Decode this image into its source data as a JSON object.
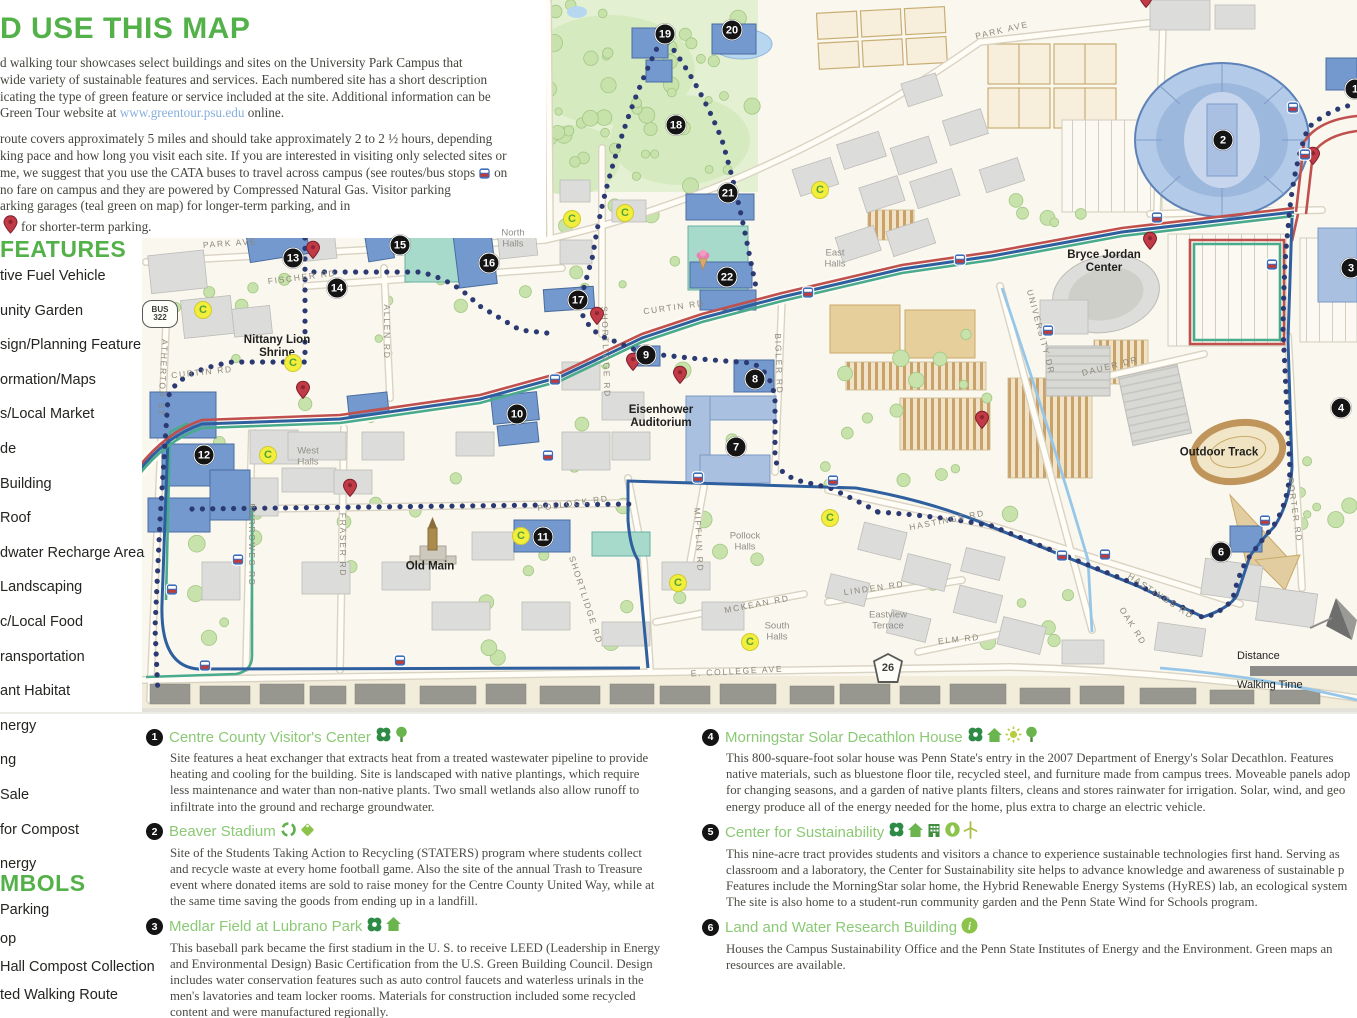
{
  "colors": {
    "heading_green": "#54b14a",
    "site_title_green": "#8bc975",
    "link_blue": "#86aede",
    "route_red": "#c0504d",
    "route_blue": "#2e5f9e",
    "route_teal": "#49ab8c",
    "walk_dot_navy": "#2b3a72"
  },
  "intro": {
    "heading": "D USE THIS MAP",
    "p1": [
      "d walking tour showcases select buildings and sites on the University Park Campus that",
      "wide variety of sustainable features and services. Each numbered site has a short description",
      "icating the type of green feature or service included at the site. Additional information can be"
    ],
    "p1_link_pre": "Green Tour website at ",
    "p1_link": "www.greentour.psu.edu",
    "p1_link_post": " online.",
    "p2": [
      "route covers approximately 5 miles and should take approximately 2 to 2 ½ hours, depending",
      "king pace and how long you visit each site. If you are interested in visiting only selected sites or"
    ],
    "p2_bus_pre": "me, we suggest that you use the CATA buses to travel across campus (see routes/bus stops",
    "p2_bus_post": "on",
    "p2b": [
      "no fare on campus and they are powered by Compressed Natural Gas. Visitor parking",
      "arking garages (teal green on map) for longer-term parking, and in"
    ],
    "p2_pin_post": "for shorter-term parking."
  },
  "sidebar": {
    "features_title": "FEATURES",
    "features": [
      "tive Fuel Vehicle",
      "unity Garden",
      "sign/Planning Feature",
      "ormation/Maps",
      "s/Local Market",
      "de",
      "Building",
      "Roof",
      "dwater Recharge Area",
      "Landscaping",
      "c/Local Food",
      "ransportation",
      "ant Habitat",
      "nergy",
      "ng",
      "Sale",
      "for Compost",
      "nergy"
    ],
    "symbols_title": "MBOLS",
    "symbols": [
      "Parking",
      "op",
      "Hall Compost Collection",
      "ted Walking Route"
    ]
  },
  "map": {
    "markers": [
      {
        "n": "1",
        "x": 1355,
        "y": 89
      },
      {
        "n": "2",
        "x": 1223,
        "y": 140
      },
      {
        "n": "3",
        "x": 1351,
        "y": 268
      },
      {
        "n": "4",
        "x": 1341,
        "y": 408
      },
      {
        "n": "6",
        "x": 1221,
        "y": 552
      },
      {
        "n": "7",
        "x": 736,
        "y": 447
      },
      {
        "n": "8",
        "x": 755,
        "y": 379
      },
      {
        "n": "9",
        "x": 646,
        "y": 355
      },
      {
        "n": "10",
        "x": 517,
        "y": 414
      },
      {
        "n": "11",
        "x": 543,
        "y": 537
      },
      {
        "n": "12",
        "x": 204,
        "y": 455
      },
      {
        "n": "13",
        "x": 293,
        "y": 258
      },
      {
        "n": "14",
        "x": 337,
        "y": 288
      },
      {
        "n": "15",
        "x": 400,
        "y": 245
      },
      {
        "n": "16",
        "x": 489,
        "y": 263
      },
      {
        "n": "17",
        "x": 578,
        "y": 300
      },
      {
        "n": "18",
        "x": 676,
        "y": 125
      },
      {
        "n": "19",
        "x": 665,
        "y": 34
      },
      {
        "n": "20",
        "x": 732,
        "y": 30
      },
      {
        "n": "21",
        "x": 728,
        "y": 193
      },
      {
        "n": "22",
        "x": 727,
        "y": 277
      }
    ],
    "road_labels": [
      {
        "t": "PARK  AVE",
        "x": 230,
        "y": 243,
        "r": -4
      },
      {
        "t": "PARK  AVE",
        "x": 1002,
        "y": 30,
        "r": -13
      },
      {
        "t": "FISCHER  RD",
        "x": 302,
        "y": 277,
        "r": -7
      },
      {
        "t": "ALLEN  RD",
        "x": 387,
        "y": 332,
        "r": 90
      },
      {
        "t": "ATHERTON  ST",
        "x": 163,
        "y": 378,
        "r": 93
      },
      {
        "t": "CURTIN  RD",
        "x": 202,
        "y": 372,
        "r": -6
      },
      {
        "t": "CURTIN  RD",
        "x": 674,
        "y": 307,
        "r": -8
      },
      {
        "t": "BURROWES  RD",
        "x": 252,
        "y": 545,
        "r": 90
      },
      {
        "t": "FRASER  RD",
        "x": 343,
        "y": 545,
        "r": 90
      },
      {
        "t": "SHORTLIDGE  RD",
        "x": 606,
        "y": 352,
        "r": 88
      },
      {
        "t": "SHORTLIDGE  RD",
        "x": 586,
        "y": 600,
        "r": 72
      },
      {
        "t": "MIFFLIN  RD",
        "x": 699,
        "y": 540,
        "r": 87
      },
      {
        "t": "BIGLER  RD",
        "x": 779,
        "y": 364,
        "r": 88
      },
      {
        "t": "POLLOCK  RD",
        "x": 573,
        "y": 503,
        "r": -8
      },
      {
        "t": "MCKEAN  RD",
        "x": 757,
        "y": 604,
        "r": -11
      },
      {
        "t": "LINDEN  RD",
        "x": 874,
        "y": 588,
        "r": -8
      },
      {
        "t": "ELM  RD",
        "x": 959,
        "y": 639,
        "r": -6
      },
      {
        "t": "E. COLLEGE  AVE",
        "x": 737,
        "y": 671,
        "r": -3
      },
      {
        "t": "HASTINGS  RD",
        "x": 947,
        "y": 520,
        "r": -11
      },
      {
        "t": "HASTINGS  RD",
        "x": 1161,
        "y": 596,
        "r": 33
      },
      {
        "t": "OAK  RD",
        "x": 1133,
        "y": 626,
        "r": 58
      },
      {
        "t": "DAUER  DR",
        "x": 1110,
        "y": 366,
        "r": -14
      },
      {
        "t": "UNIVERSITY  DR",
        "x": 1041,
        "y": 332,
        "r": 75
      },
      {
        "t": "PORTER  RD",
        "x": 1295,
        "y": 510,
        "r": 82
      }
    ],
    "place_labels": [
      {
        "t": "North\nHalls",
        "x": 513,
        "y": 239
      },
      {
        "t": "West\nHalls",
        "x": 308,
        "y": 457
      },
      {
        "t": "East\nHalls",
        "x": 835,
        "y": 259
      },
      {
        "t": "Pollock\nHalls",
        "x": 745,
        "y": 542
      },
      {
        "t": "South\nHalls",
        "x": 777,
        "y": 632
      },
      {
        "t": "Eastview\nTerrace",
        "x": 888,
        "y": 621
      }
    ],
    "poi_labels": [
      {
        "t": "Nittany Lion\nShrine",
        "x": 277,
        "y": 347
      },
      {
        "t": "Old Main",
        "x": 430,
        "y": 567
      },
      {
        "t": "Eisenhower\nAuditorium",
        "x": 661,
        "y": 417
      },
      {
        "t": "Bryce Jordan\nCenter",
        "x": 1104,
        "y": 262
      },
      {
        "t": "Outdoor Track",
        "x": 1219,
        "y": 453
      }
    ],
    "pins": [
      {
        "x": 313,
        "y": 262
      },
      {
        "x": 303,
        "y": 402
      },
      {
        "x": 350,
        "y": 500
      },
      {
        "x": 597,
        "y": 328
      },
      {
        "x": 633,
        "y": 374
      },
      {
        "x": 680,
        "y": 387
      },
      {
        "x": 982,
        "y": 432
      },
      {
        "x": 1150,
        "y": 253
      },
      {
        "x": 1313,
        "y": 168
      },
      {
        "x": 1146,
        "y": 11
      }
    ],
    "buses": [
      {
        "x": 205,
        "y": 668
      },
      {
        "x": 400,
        "y": 663
      },
      {
        "x": 172,
        "y": 592
      },
      {
        "x": 238,
        "y": 562
      },
      {
        "x": 555,
        "y": 382
      },
      {
        "x": 548,
        "y": 458
      },
      {
        "x": 698,
        "y": 480
      },
      {
        "x": 833,
        "y": 483
      },
      {
        "x": 808,
        "y": 295
      },
      {
        "x": 960,
        "y": 262
      },
      {
        "x": 1048,
        "y": 333
      },
      {
        "x": 1062,
        "y": 558
      },
      {
        "x": 1105,
        "y": 557
      },
      {
        "x": 1157,
        "y": 220
      },
      {
        "x": 1272,
        "y": 267
      },
      {
        "x": 1293,
        "y": 110
      },
      {
        "x": 1305,
        "y": 157
      },
      {
        "x": 1265,
        "y": 523
      }
    ],
    "c_stops": [
      {
        "x": 203,
        "y": 310
      },
      {
        "x": 293,
        "y": 363
      },
      {
        "x": 268,
        "y": 455
      },
      {
        "x": 572,
        "y": 219
      },
      {
        "x": 625,
        "y": 213
      },
      {
        "x": 820,
        "y": 190
      },
      {
        "x": 830,
        "y": 518
      },
      {
        "x": 678,
        "y": 583
      },
      {
        "x": 750,
        "y": 642
      },
      {
        "x": 521,
        "y": 536
      }
    ],
    "icons": [
      {
        "name": "creamery-icon",
        "kind": "icecream",
        "x": 703,
        "y": 262
      }
    ],
    "shields": {
      "bus_label": "BUS",
      "bus_num": "322",
      "route_num": "26"
    },
    "scale": {
      "distance": "Distance",
      "walking": "Walking Time"
    }
  },
  "sites": {
    "left": [
      {
        "num": "1",
        "title": "Centre County Visitor's Center",
        "icons": [
          "pinwheel",
          "tree"
        ],
        "lines": [
          "Site features a heat exchanger that extracts heat from a treated wastewater pipeline to provide",
          "heating and cooling for the building. Site is landscaped with native plantings, which require",
          "less maintenance and water than non-native plants. Two small wetlands also allow runoff  to",
          "infiltrate into the ground and recharge groundwater."
        ]
      },
      {
        "num": "2",
        "title": "Beaver Stadium",
        "icons": [
          "recycle",
          "tag"
        ],
        "lines": [
          "Site of  the Students Taking Action to Recycling (STATERS) program where students collect",
          "and recycle waste at every home football game. Also the site of  the annual Trash to Treasure",
          "event where donated items are sold to raise money for the Centre County United Way, while at",
          "the same time saving the goods from ending up in a landfill."
        ]
      },
      {
        "num": "3",
        "title": "Medlar Field at Lubrano Park",
        "icons": [
          "pinwheel",
          "house"
        ],
        "lines": [
          "This baseball park became the first stadium in the U. S. to receive LEED (Leadership in Energy",
          "and Environmental Design) Basic Certification from the U.S. Green Building Council. Design",
          "includes water conservation features such as auto control faucets and waterless urinals in the",
          "men's lavatories and team locker rooms. Materials for construction included some recycled",
          "content and were manufactured regionally."
        ]
      }
    ],
    "right": [
      {
        "num": "4",
        "title": "Morningstar Solar Decathlon House",
        "icons": [
          "pinwheel",
          "house",
          "sun",
          "tree"
        ],
        "lines": [
          "This 800-square-foot solar house was Penn State's entry in the 2007 Department of  Energy's Solar Decathlon. Features",
          "native materials, such as bluestone floor tile, recycled steel, and furniture made from campus trees. Moveable panels adop",
          "for changing seasons, and a garden of  native plants filters, cleans and stores rainwater for irrigation. Solar, wind, and geo",
          "energy produce all of  the energy needed for the home, plus extra to charge an electric vehicle."
        ]
      },
      {
        "num": "5",
        "title": "Center for Sustainability",
        "icons": [
          "pinwheel",
          "house",
          "building",
          "leaf",
          "turbine"
        ],
        "lines": [
          "This nine-acre tract provides students and visitors a chance to experience sustainable technologies first hand.  Serving as",
          "classroom and a laboratory, the Center for Sustainability site helps to advance knowledge and awareness of  sustainable p",
          "Features include the MorningStar solar home, the Hybrid Renewable Energy Systems (HyRES) lab, an ecological system",
          "The site is also home to a student-run community garden and the Penn State Wind for Schools program."
        ]
      },
      {
        "num": "6",
        "title": "Land and Water Research Building",
        "icons": [
          "info"
        ],
        "lines": [
          "Houses the Campus Sustainability Office and the Penn State Institutes of  Energy and the Environment. Green maps an",
          "resources are available."
        ]
      }
    ]
  }
}
